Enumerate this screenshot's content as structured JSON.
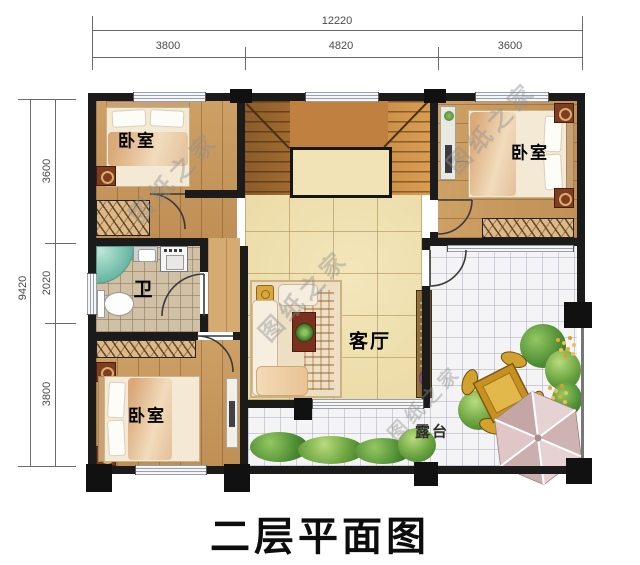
{
  "title": "二层平面图",
  "watermark": "图纸之家",
  "dims": {
    "top_total": "12220",
    "top_segs": [
      "3800",
      "4820",
      "3600"
    ],
    "left_total": "9420",
    "left_segs": [
      "3600",
      "2020",
      "3800"
    ]
  },
  "rooms": {
    "bedroom_tl": "卧室",
    "bedroom_tr": "卧室",
    "bedroom_bl": "卧室",
    "bath": "卫",
    "living": "客厅",
    "terrace": "露台"
  },
  "colors": {
    "wall": "#1b1b1b",
    "wood": "#c79a61",
    "living_tile": "#ead9a4",
    "terrace_tile": "#f4f4f6",
    "greenery": "#4f8d34",
    "umbrella": "#d8bcbc"
  }
}
